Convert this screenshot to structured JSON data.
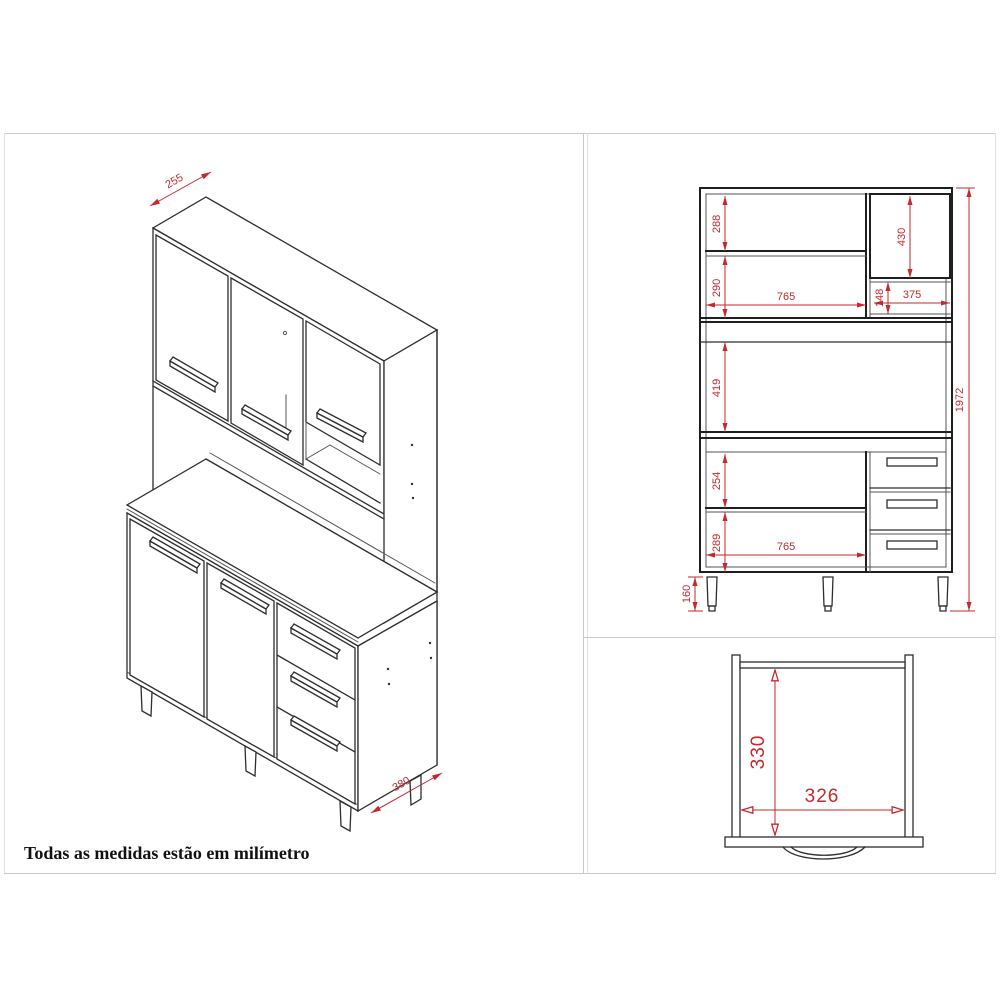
{
  "note": "Todas as medidas estão em milímetro",
  "colors": {
    "dimension_red": "#c22a2e",
    "line_dark": "#2e2e2e",
    "frame_gray": "#c9c9c9"
  },
  "isometric": {
    "top_depth": "255",
    "base_depth": "380"
  },
  "front": {
    "upper_left_top_space": "288",
    "upper_left_bottom_space": "290",
    "upper_right_door_height": "430",
    "upper_opening_width": "765",
    "upper_right_niche_height": "148",
    "upper_right_niche_width": "375",
    "middle_niche_height": "419",
    "base_upper_space": "254",
    "base_lower_space": "289",
    "base_opening_width": "765",
    "leg_height": "160",
    "total_height": "1972"
  },
  "top_view": {
    "inner_depth": "330",
    "inner_width": "326"
  }
}
